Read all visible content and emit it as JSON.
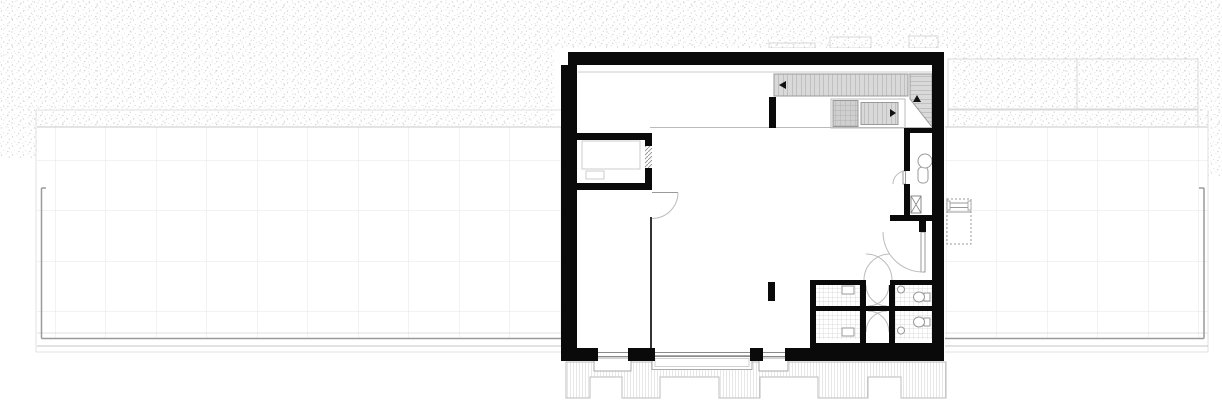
{
  "labels": {
    "fixture_b": "B"
  },
  "colors": {
    "wall": "#0a0a0a",
    "partition": "#333333",
    "stair_fill": "#d9d9d9",
    "tread_line": "#a8a8a8",
    "terrace_grid": "#e4e4e4",
    "railing": "#9a9a9a",
    "tile_line": "#d0d0d0",
    "stipple_dot": "#d2d2d2",
    "door_arc": "#bbbbbb",
    "facade_hatch": "#cfcfcf"
  },
  "plan": {
    "regions": [
      "left-roof-terrace",
      "main-hall",
      "entry-room",
      "stair-hall",
      "upper-bathroom",
      "sanitary-block",
      "right-roof-terrace",
      "lower-facade-band"
    ]
  }
}
